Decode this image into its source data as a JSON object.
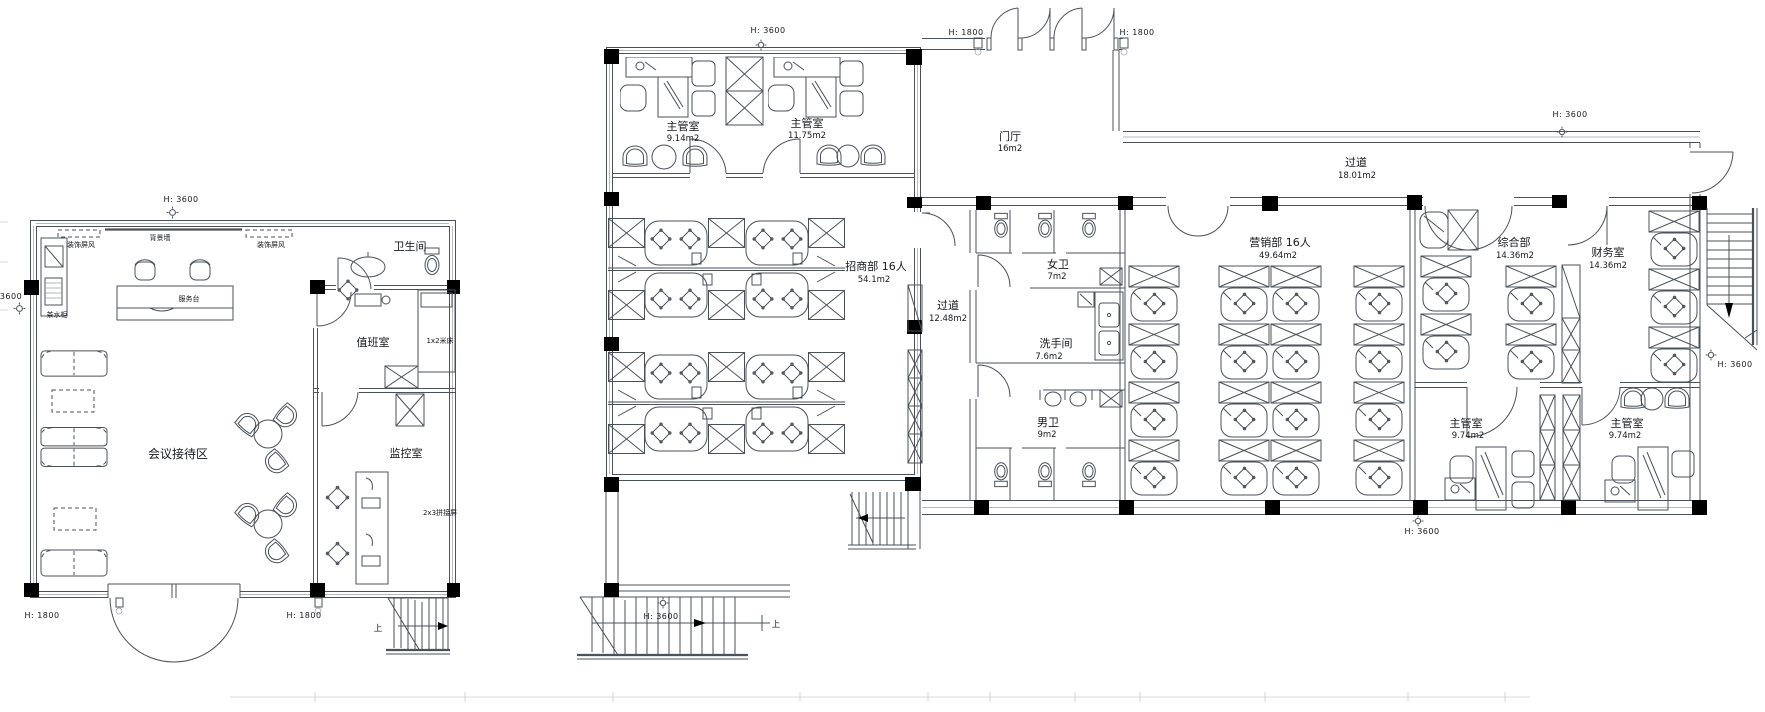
{
  "colors": {
    "wall": "#4b5158",
    "column": "#000000",
    "light_line": "#9aa1a8",
    "label": "#15181c"
  },
  "left_building": {
    "header_height": "H: 3600",
    "left_dim": "3600",
    "door_height_left": "H: 1800",
    "door_height_right": "H: 1800",
    "stairs_up": "上",
    "rooms": {
      "reception": {
        "name": "会议接待区"
      },
      "toilet": {
        "name": "卫生间"
      },
      "duty": {
        "name": "值班室"
      },
      "monitor": {
        "name": "监控室"
      }
    },
    "annotations": {
      "bg_wall": "背景墙",
      "screen_left": "装饰屏风",
      "screen_right": "装饰屏风",
      "service_desk": "服务台",
      "tea_cabinet": "茶水柜",
      "bed": "1x2米床",
      "splice_screen": "2x3拼接屏"
    }
  },
  "middle_building": {
    "header_height": "H: 3600",
    "stairs_height": "H: 3600",
    "stairs_up": "上",
    "rooms": {
      "chief1": {
        "name": "主管室",
        "area": "9.14m2"
      },
      "chief2": {
        "name": "主管室",
        "area": "11.75m2"
      },
      "business": {
        "name": "招商部  16人",
        "area": "54.1m2"
      }
    }
  },
  "right_building": {
    "entry_height_left": "H: 1800",
    "entry_height_right": "H: 1800",
    "corridor_height": "H: 3600",
    "stairs_height": "H: 3600",
    "bottom_height": "H: 3600",
    "rooms": {
      "foyer": {
        "name": "门厅",
        "area": "16m2"
      },
      "corridor_top": {
        "name": "过道",
        "area": "18.01m2"
      },
      "corridor_west": {
        "name": "过道",
        "area": "12.48m2"
      },
      "wc_women": {
        "name": "女卫",
        "area": "7m2"
      },
      "washroom": {
        "name": "洗手间",
        "area": "7.6m2"
      },
      "wc_men": {
        "name": "男卫",
        "area": "9m2"
      },
      "marketing": {
        "name": "营销部  16人",
        "area": "49.64m2"
      },
      "general": {
        "name": "综合部",
        "area": "14.36m2"
      },
      "finance": {
        "name": "财务室",
        "area": "14.36m2"
      },
      "chief_sw": {
        "name": "主管室",
        "area": "9.74m2"
      },
      "chief_se": {
        "name": "主管室",
        "area": "9.74m2"
      }
    }
  }
}
